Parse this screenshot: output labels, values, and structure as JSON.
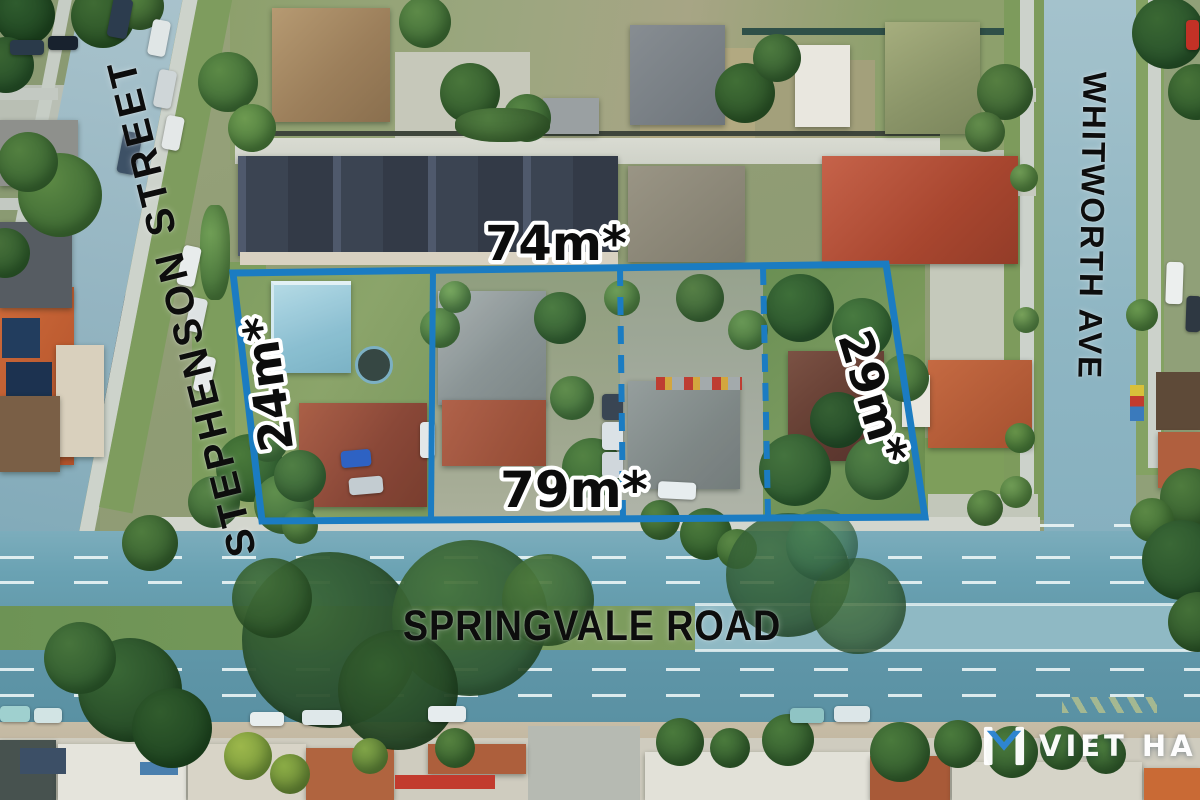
{
  "annotations": {
    "street_left": "STEPHENSON STREET",
    "street_right": "WHITWORTH AVE",
    "street_bottom": "SPRINGVALE ROAD",
    "dim_top": "74m*",
    "dim_left": "24m*",
    "dim_right": "29m*",
    "dim_bottom": "79m*"
  },
  "site": {
    "boundary_color": "#1b7cc2",
    "lot_count": 4,
    "boundary_style": {
      "outer": "solid",
      "dividers": [
        "solid",
        "dashed",
        "dashed"
      ]
    }
  },
  "watermark": {
    "text": "VIET HA",
    "text_color": "#ffffff",
    "mark_color": "#2e86d4"
  },
  "scene": {
    "description": "Aerial drone photograph of a four-lot development site bounded by Stephenson Street, Whitworth Ave and Springvale Road; road surfaces tinted blue",
    "road_tint": "#6aa2b3"
  }
}
